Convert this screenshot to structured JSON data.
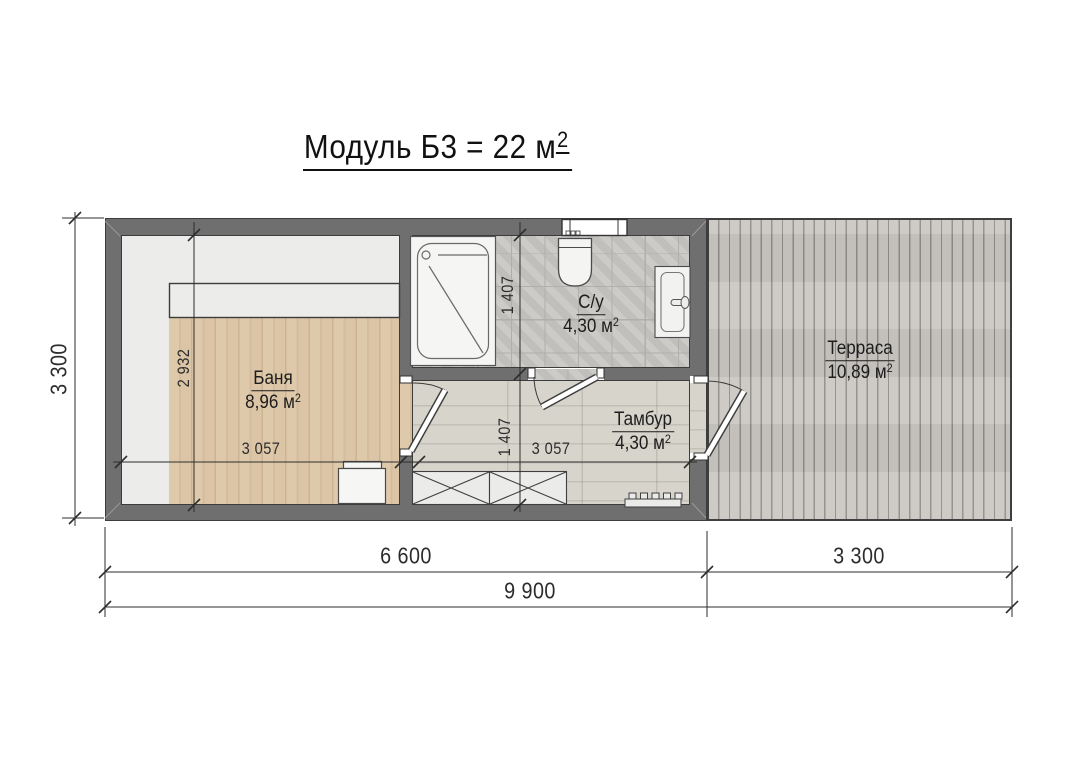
{
  "title": {
    "text": "Модуль Б3 = 22 м",
    "sup": "2"
  },
  "rooms": {
    "banya": {
      "name": "Баня",
      "area": "8,96 м",
      "area_sup": "2"
    },
    "su": {
      "name": "С/у",
      "area": "4,30 м",
      "area_sup": "2"
    },
    "tambur": {
      "name": "Тамбур",
      "area": "4,30 м",
      "area_sup": "2"
    },
    "terrace": {
      "name": "Терраса",
      "area": "10,89 м",
      "area_sup": "2"
    }
  },
  "dimensions": {
    "overall_height": "3 300",
    "banya_height": "2 932",
    "banya_width": "3 057",
    "su_height": "1 407",
    "tambur_height": "1 407",
    "tambur_width": "3 057",
    "module_width": "6 600",
    "terrace_width": "3 300",
    "total_width": "9 900"
  },
  "palette": {
    "wall": "#6f6f6f",
    "banya_room": "#ececeb",
    "banya_wood": "#d9c3a4",
    "su_tile": "#c7c5c2",
    "tambur_floor": "#d6d3cb",
    "terrace_deck": "#c8c6c2",
    "dimension_lines": "#2d2d2d",
    "fixtures": "#f4f4f3"
  }
}
